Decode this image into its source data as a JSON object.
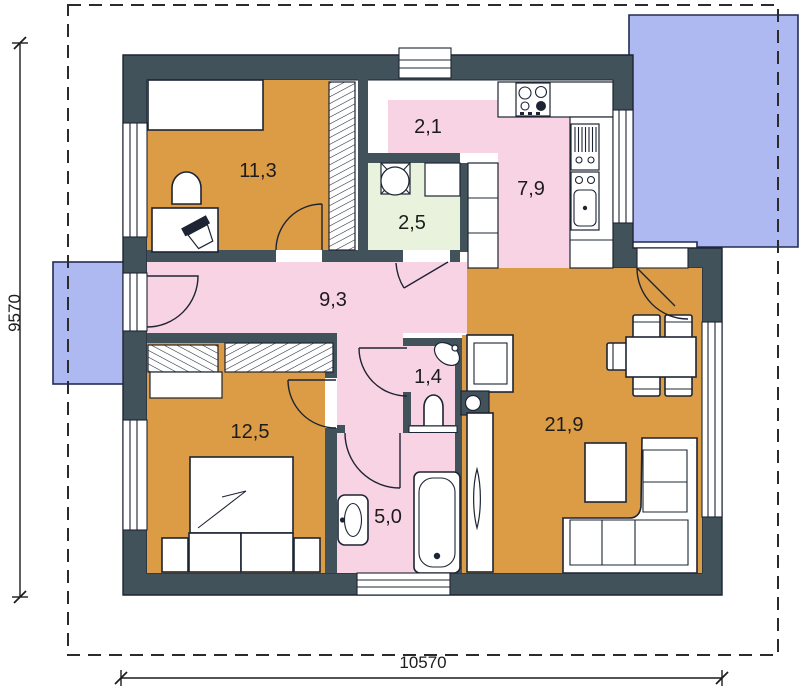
{
  "plan": {
    "type": "single-storey house floor plan",
    "dimensions": {
      "vertical": "9570",
      "horizontal": "10570"
    },
    "rooms": [
      {
        "id": "bedroom-1",
        "label": "11,3"
      },
      {
        "id": "entry",
        "label": "2,1"
      },
      {
        "id": "utility",
        "label": "2,5"
      },
      {
        "id": "kitchen",
        "label": "7,9"
      },
      {
        "id": "hallway",
        "label": "9,3"
      },
      {
        "id": "wc",
        "label": "1,4"
      },
      {
        "id": "bedroom-2",
        "label": "12,5"
      },
      {
        "id": "living-dining",
        "label": "21,9"
      },
      {
        "id": "bathroom",
        "label": "5,0"
      }
    ],
    "furniture_icons": [
      "double-bed",
      "single-bed",
      "wardrobe",
      "desk",
      "office-chair",
      "armchair",
      "washing-machine",
      "cooktop",
      "dish-rack",
      "kitchen-sink",
      "corner-washbasin",
      "toilet",
      "washbasin",
      "bathtub",
      "tv-cabinet",
      "water-heater",
      "tall-cabinet",
      "dining-table",
      "chair",
      "coffee-table",
      "corner-sofa"
    ]
  },
  "colors": {
    "wall": "#42525A",
    "outline": "#1d2433",
    "room_orange": "#DC9C45",
    "room_pink": "#F8D3E3",
    "room_green": "#E9F2DC",
    "terrace_blue": "#AEB9F2",
    "paper": "#FFFFFF",
    "ink": "#1c1c1c"
  }
}
